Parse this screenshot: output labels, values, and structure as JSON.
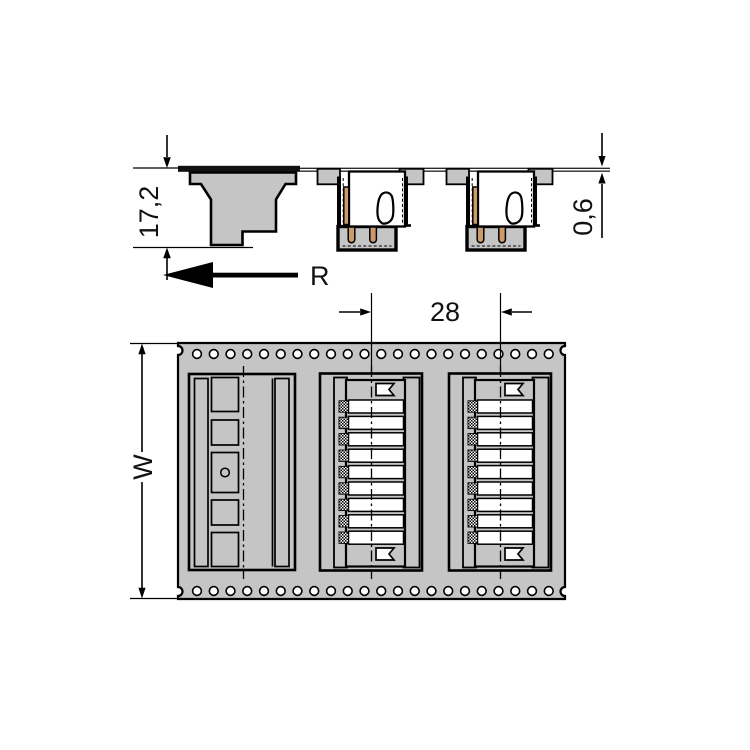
{
  "colors": {
    "tape_gray": "#c5c5c5",
    "contact_orange": "#cd9a69",
    "line": "#000000",
    "background": "#ffffff"
  },
  "side_view": {
    "height_dimension": "17,2",
    "tape_thickness_dimension": "0,6",
    "reel_direction_label": "R"
  },
  "top_view": {
    "pitch_dimension": "28",
    "tape_width_label": "W",
    "sprocket_holes_per_row": 22,
    "connector_positions_per_part": 9,
    "pocket_count": 3
  }
}
